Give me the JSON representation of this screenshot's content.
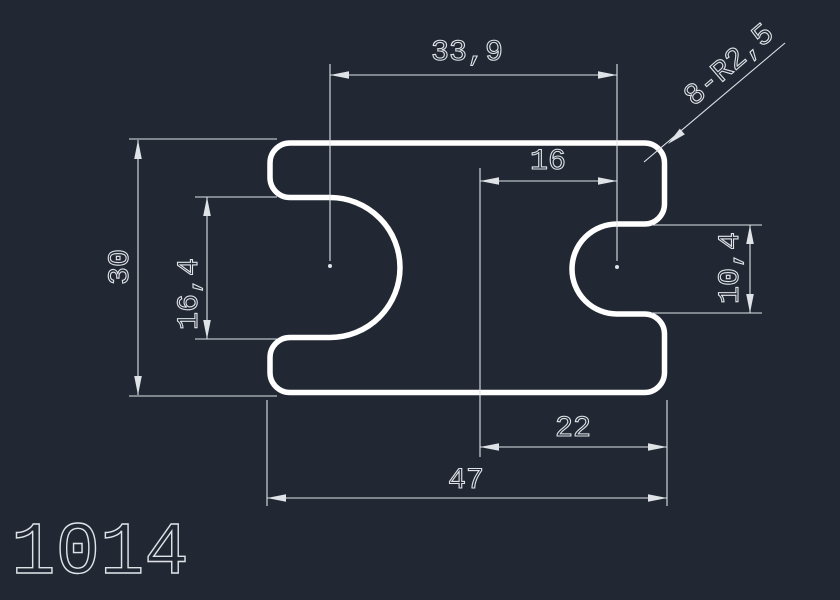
{
  "canvas": {
    "background_color": "#222833",
    "outline_color": "#ffffff",
    "dim_color": "#dfe3e8"
  },
  "drawing": {
    "part_number": "1014",
    "labels": {
      "top_width": "33,9",
      "corner_radius_note": "8-R2,5",
      "upper_right_width": "16",
      "overall_height": "30",
      "left_notch_height": "16,4",
      "right_notch_height": "10,4",
      "lower_right_width": "22",
      "overall_width": "47"
    }
  }
}
